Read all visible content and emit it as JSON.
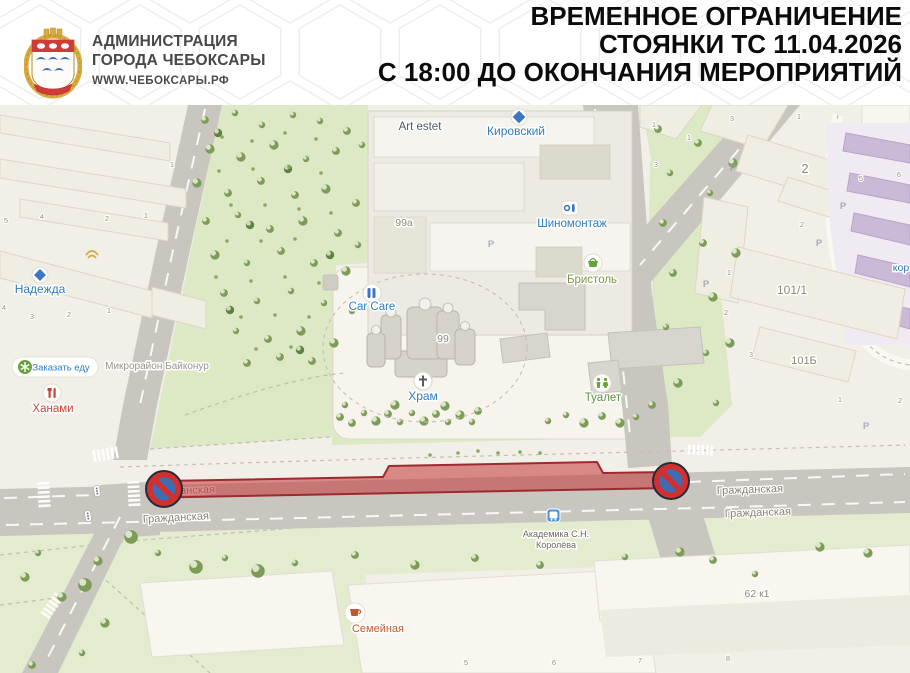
{
  "header": {
    "org_line1": "АДМИНИСТРАЦИЯ",
    "org_line2": "ГОРОДА ЧЕБОКСАРЫ",
    "website": "WWW.ЧЕБОКСАРЫ.РФ",
    "title_line1": "ВРЕМЕННОЕ ОГРАНИЧЕНИЕ",
    "title_line2": "СТОЯНКИ ТС 11.04.2026",
    "title_line3": "С 18:00 ДО ОКОНЧАНИЯ МЕРОПРИЯТИЙ"
  },
  "map": {
    "poi": {
      "art_estet": "Art estet",
      "kirovsky": "Кировский",
      "shinomontazh": "Шиномонтаж",
      "bristol": "Бристоль",
      "car_care": "Car Care",
      "khram": "Храм",
      "toilet": "Туалет",
      "nadezhda": "Надежда",
      "order_food": "Заказать еду",
      "khanami": "Ханами",
      "baikonur": "Микрорайон Байконур",
      "semeynaya": "Семейная",
      "bus_stop_line1": "Академика С.Н.",
      "bus_stop_line2": "Королёва",
      "koro_partial": "кор"
    },
    "building_numbers": {
      "b99a": "99а",
      "b99": "99",
      "b2": "2",
      "b101_1": "101/1",
      "b101b": "101Б",
      "b62k1": "62 к1"
    },
    "street_labels": [
      {
        "text": "Гражданская",
        "x": 182,
        "y": 389,
        "rot": -2
      },
      {
        "text": "Гражданская",
        "x": 176,
        "y": 416,
        "rot": -3
      },
      {
        "text": "Гражданская",
        "x": 750,
        "y": 388,
        "rot": -2
      },
      {
        "text": "Гражданская",
        "x": 758,
        "y": 411,
        "rot": -2
      }
    ],
    "entrance_numbers": [
      {
        "n": "1",
        "x": 172,
        "y": 62
      },
      {
        "n": "5",
        "x": 6,
        "y": 118
      },
      {
        "n": "4",
        "x": 42,
        "y": 114
      },
      {
        "n": "2",
        "x": 107,
        "y": 116
      },
      {
        "n": "1",
        "x": 146,
        "y": 113
      },
      {
        "n": "4",
        "x": 4,
        "y": 205
      },
      {
        "n": "3",
        "x": 32,
        "y": 214
      },
      {
        "n": "2",
        "x": 69,
        "y": 212
      },
      {
        "n": "1",
        "x": 109,
        "y": 208
      },
      {
        "n": "1",
        "x": 654,
        "y": 22
      },
      {
        "n": "3",
        "x": 732,
        "y": 16
      },
      {
        "n": "1",
        "x": 799,
        "y": 14
      },
      {
        "n": "1",
        "x": 689,
        "y": 35
      },
      {
        "n": "3",
        "x": 656,
        "y": 62
      },
      {
        "n": "5",
        "x": 861,
        "y": 76
      },
      {
        "n": "6",
        "x": 899,
        "y": 72
      },
      {
        "n": "2",
        "x": 802,
        "y": 122
      },
      {
        "n": "1",
        "x": 729,
        "y": 170
      },
      {
        "n": "2",
        "x": 726,
        "y": 210
      },
      {
        "n": "3",
        "x": 751,
        "y": 252
      },
      {
        "n": "1",
        "x": 840,
        "y": 297
      },
      {
        "n": "2",
        "x": 900,
        "y": 298
      },
      {
        "n": "5",
        "x": 466,
        "y": 560
      },
      {
        "n": "6",
        "x": 554,
        "y": 560
      },
      {
        "n": "7",
        "x": 640,
        "y": 558
      },
      {
        "n": "8",
        "x": 728,
        "y": 556
      }
    ],
    "parking_letter": "Р",
    "parking_positions": [
      {
        "x": 491,
        "y": 142
      },
      {
        "x": 733,
        "y": 66
      },
      {
        "x": 843,
        "y": 104
      },
      {
        "x": 819,
        "y": 141
      },
      {
        "x": 866,
        "y": 324
      },
      {
        "x": 706,
        "y": 182
      }
    ],
    "restriction": {
      "sign": "no-parking",
      "sign_count": 2
    }
  },
  "colors": {
    "accent_red": "#c33434",
    "sign_blue": "#3f6cb3",
    "sign_ring": "#d22f2f",
    "sign_outline": "#222c3a",
    "poi_blue": "#2e7cc2",
    "poi_green": "#5f9143",
    "poi_olive": "#7f9545",
    "poi_red": "#c2473a",
    "poi_orange": "#c05a2e",
    "label_gray": "#9a948a",
    "street_label": "#8a8375",
    "road_gray": "#c9c6c0",
    "park_green": "#dde8c4",
    "lawn_green": "#e3ecce",
    "map_bg": "#f1efe8"
  }
}
